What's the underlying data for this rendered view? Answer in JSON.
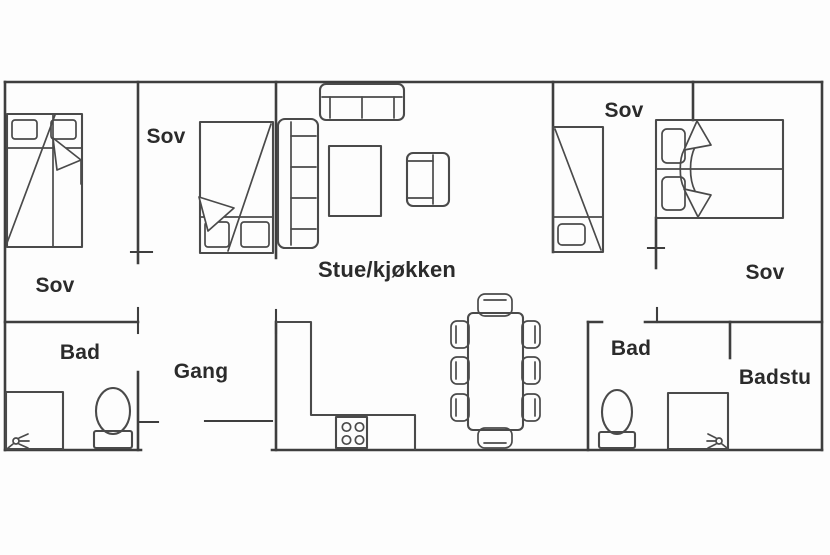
{
  "colors": {
    "wall": "#3e3e3e",
    "furniture": "#4a4a4a",
    "text": "#2b2b2b",
    "background": "#fdfdfd"
  },
  "rooms": {
    "bedroom_left": {
      "label": "Sov"
    },
    "bedroom_middle": {
      "label": "Sov"
    },
    "living_kitchen": {
      "label": "Stue/kjøkken"
    },
    "bedroom_right_small": {
      "label": "Sov"
    },
    "bedroom_right_large": {
      "label": "Sov"
    },
    "bathroom_left": {
      "label": "Bad"
    },
    "hallway": {
      "label": "Gang"
    },
    "bathroom_right": {
      "label": "Bad"
    },
    "sauna": {
      "label": "Badstu"
    }
  },
  "icons": {
    "shower_head": "shower-spray",
    "sauna_heater": "sauna-spray"
  }
}
